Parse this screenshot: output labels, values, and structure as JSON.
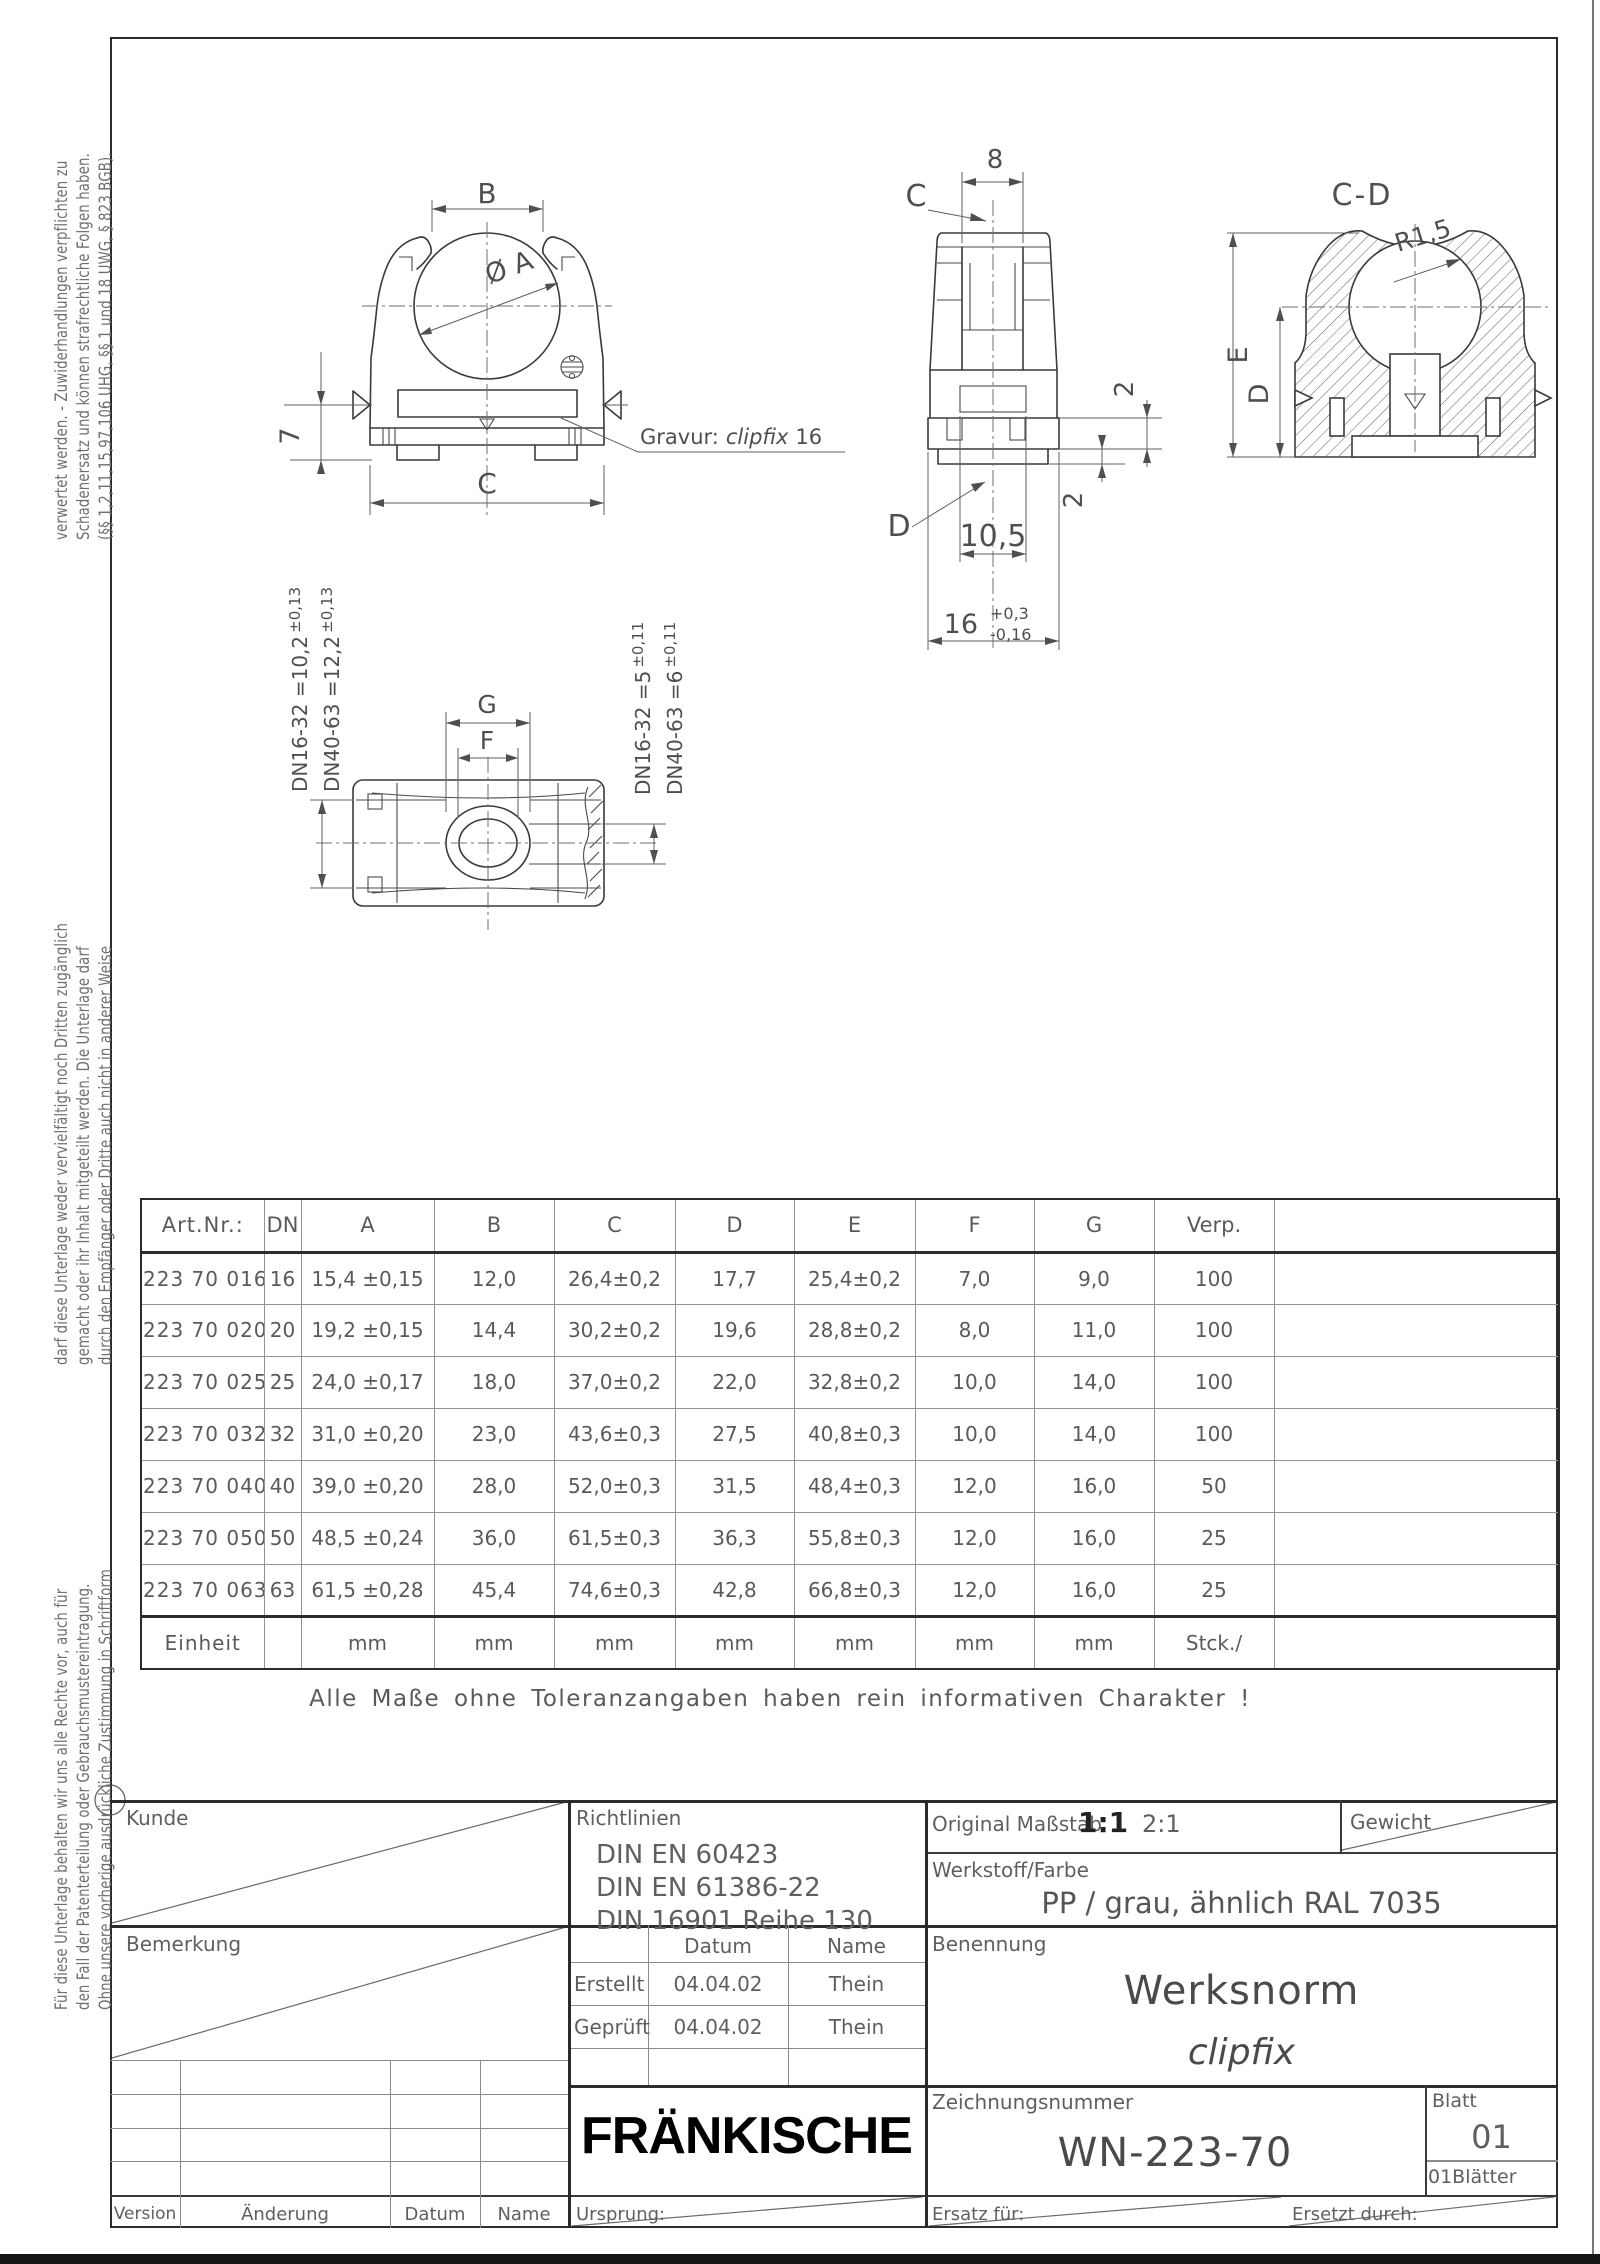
{
  "colors": {
    "paper": "#ffffff",
    "line_dark": "#2b2b2b",
    "line_mid": "#5a5a5a",
    "logo": "#000000"
  },
  "margin_notes": {
    "block_top": [
      "verwertet werden. - Zuwiderhandlungen verpflichten zu",
      "Schadenersatz und können strafrechtliche Folgen haben.",
      "(§§ 1,2,11,15,97,106 UHG, §§ 1 und 18 UWG, § 823 BGB)."
    ],
    "block_middle": [
      "darf diese Unterlage weder vervielfältigt noch Dritten zugänglich",
      "gemacht oder ihr Inhalt mitgeteilt werden. Die Unterlage darf",
      "durch den Empfänger oder Dritte auch nicht in anderer Weise"
    ],
    "block_bottom": [
      "Für diese Unterlage behalten wir uns alle Rechte vor, auch für",
      "den Fall der Patenterteilung oder Gebrauchsmustereintragung.",
      "Ohne unsere vorherige ausdrückliche Zustimmung in Schriftform"
    ]
  },
  "drawings": {
    "front_view": {
      "dim_b": "B",
      "dim_dia": "Ø A",
      "dim_height": "7",
      "dim_c": "C",
      "engraving_prefix": "Gravur:",
      "engraving_name": "clipfix",
      "engraving_size": "16"
    },
    "side_view": {
      "dim_width": "8",
      "label_c": "C",
      "label_d": "D",
      "dim_gap": "2",
      "dim_plate": "2",
      "dim_slot": "10,5",
      "dim_base": "16",
      "dim_base_tol_plus": "+0,3",
      "dim_base_tol_minus": "-0,16"
    },
    "section_view": {
      "title": "C-D",
      "radius": "R1,5",
      "dim_e": "E",
      "dim_d": "D"
    },
    "bottom_view": {
      "dim_g": "G",
      "dim_f": "F",
      "left_note_1": "DN16-32 =10,2",
      "left_note_1_tol": "±0,13",
      "left_note_2": "DN40-63 =12,2",
      "left_note_2_tol": "±0,13",
      "right_note_1": "DN16-32 =5",
      "right_note_1_tol": "±0,11",
      "right_note_2": "DN40-63 =6",
      "right_note_2_tol": "±0,11"
    }
  },
  "table": {
    "headers": [
      "Art.Nr.:",
      "DN",
      "A",
      "B",
      "C",
      "D",
      "E",
      "F",
      "G",
      "Verp.",
      ""
    ],
    "rows": [
      [
        "223 70 016",
        "16",
        "15,4 ±0,15",
        "12,0",
        "26,4±0,2",
        "17,7",
        "25,4±0,2",
        "7,0",
        "9,0",
        "100",
        ""
      ],
      [
        "223 70 020",
        "20",
        "19,2 ±0,15",
        "14,4",
        "30,2±0,2",
        "19,6",
        "28,8±0,2",
        "8,0",
        "11,0",
        "100",
        ""
      ],
      [
        "223 70 025",
        "25",
        "24,0 ±0,17",
        "18,0",
        "37,0±0,2",
        "22,0",
        "32,8±0,2",
        "10,0",
        "14,0",
        "100",
        ""
      ],
      [
        "223 70 032",
        "32",
        "31,0 ±0,20",
        "23,0",
        "43,6±0,3",
        "27,5",
        "40,8±0,3",
        "10,0",
        "14,0",
        "100",
        ""
      ],
      [
        "223 70 040",
        "40",
        "39,0 ±0,20",
        "28,0",
        "52,0±0,3",
        "31,5",
        "48,4±0,3",
        "12,0",
        "16,0",
        "50",
        ""
      ],
      [
        "223 70 050",
        "50",
        "48,5 ±0,24",
        "36,0",
        "61,5±0,3",
        "36,3",
        "55,8±0,3",
        "12,0",
        "16,0",
        "25",
        ""
      ],
      [
        "223 70 063",
        "63",
        "61,5 ±0,28",
        "45,4",
        "74,6±0,3",
        "42,8",
        "66,8±0,3",
        "12,0",
        "16,0",
        "25",
        ""
      ]
    ],
    "unit_row": [
      "Einheit",
      "",
      "mm",
      "mm",
      "mm",
      "mm",
      "mm",
      "mm",
      "mm",
      "Stck./",
      ""
    ]
  },
  "note": "Alle Maße ohne Toleranzangaben haben rein informativen Charakter !",
  "title_block": {
    "kunde_label": "Kunde",
    "richtlinien_label": "Richtlinien",
    "richtlinien_lines": [
      "DIN EN 60423",
      "DIN EN 61386-22",
      "DIN 16901 Reihe 130"
    ],
    "massstab_label": "Original Maßstab",
    "massstab_primary": "1:1",
    "massstab_secondary": "2:1",
    "gewicht_label": "Gewicht",
    "werkstoff_label": "Werkstoff/Farbe",
    "werkstoff_value": "PP / grau, ähnlich RAL 7035",
    "bemerkung_label": "Bemerkung",
    "datum_header": "Datum",
    "name_header": "Name",
    "erstellt_label": "Erstellt",
    "erstellt_datum": "04.04.02",
    "erstellt_name": "Thein",
    "geprueft_label": "Geprüft",
    "geprueft_datum": "04.04.02",
    "geprueft_name": "Thein",
    "benennung_label": "Benennung",
    "benennung_title": "Werksnorm",
    "benennung_subtitle": "clipfix",
    "logo_text": "FRÄNKISCHE",
    "zeichnungsnummer_label": "Zeichnungsnummer",
    "zeichnungsnummer_value": "WN-223-70",
    "blatt_label": "Blatt",
    "blatt_value": "01",
    "blaetter_value": "01Blätter",
    "version_label": "Version",
    "aenderung_label": "Änderung",
    "datum_label": "Datum",
    "name_label": "Name",
    "ursprung_label": "Ursprung:",
    "ersatz_label": "Ersatz für:",
    "ersetzt_label": "Ersetzt durch:"
  }
}
